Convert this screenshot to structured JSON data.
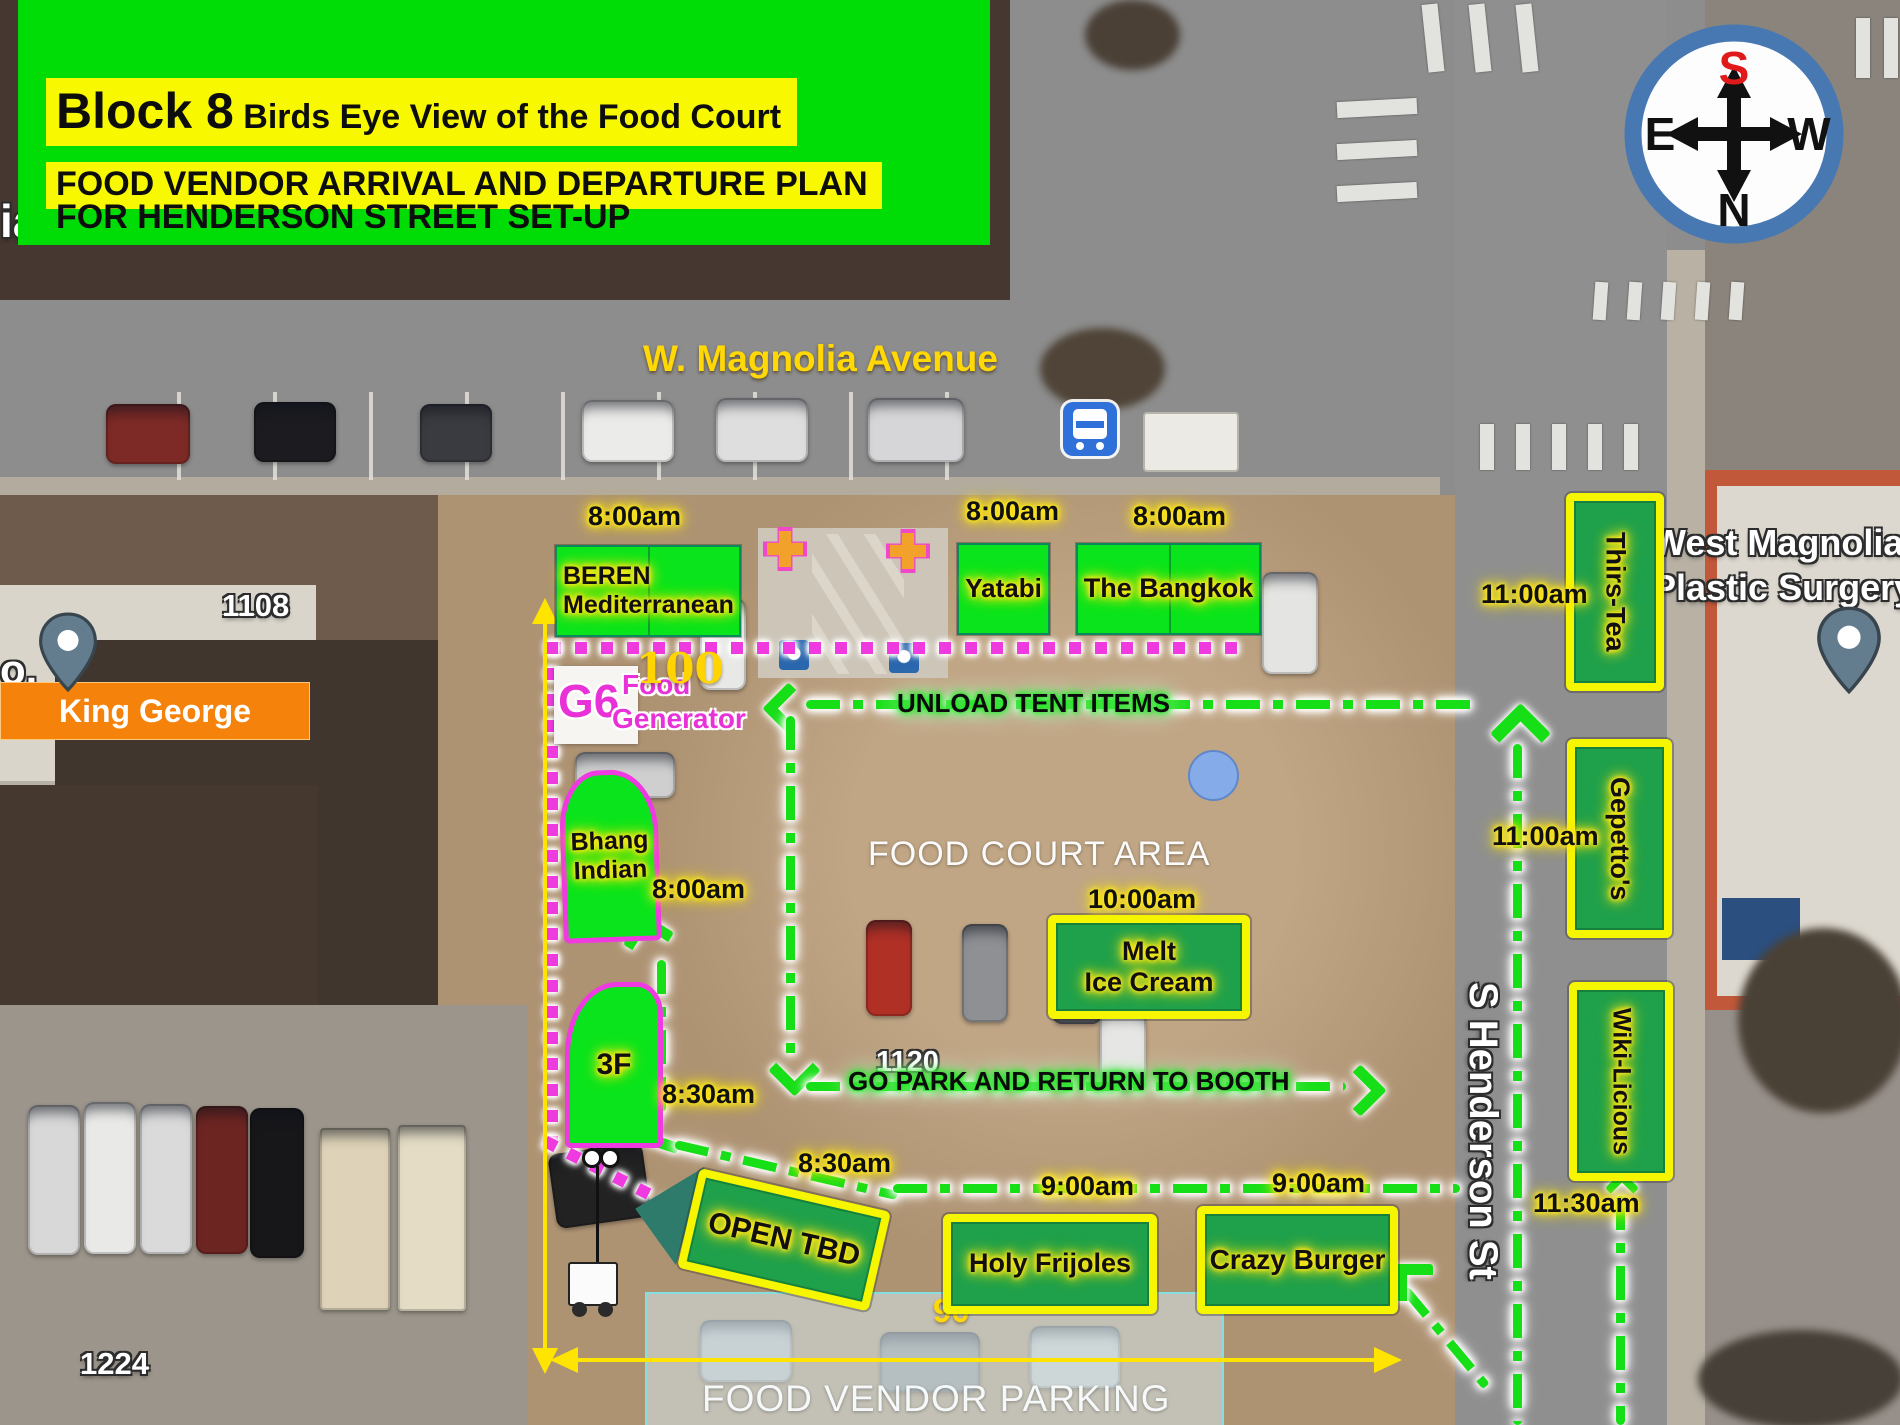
{
  "header": {
    "block": "Block 8",
    "subtitle": " Birds Eye View of the Food Court",
    "line2": "FOOD VENDOR ARRIVAL AND DEPARTURE PLAN",
    "line3": "FOR HENDERSON STREET SET-UP"
  },
  "compass": {
    "top": "S",
    "bottom": "N",
    "left": "E",
    "right": "W"
  },
  "streets": {
    "magnolia": "W. Magnolia Avenue",
    "henderson": "S Henderson St"
  },
  "areas": {
    "food_court": "FOOD COURT AREA",
    "vendor_parking": "FOOD VENDOR PARKING"
  },
  "routes": {
    "unload": "UNLOAD TENT ITEMS",
    "go_park": "GO PARK AND RETURN TO BOOTH"
  },
  "vendors": {
    "beren": {
      "line1": "BEREN",
      "line2": "Mediterranean",
      "time": "8:00am"
    },
    "yatabi": {
      "name": "Yatabi",
      "time": "8:00am"
    },
    "bangkok": {
      "name": "The Bangkok",
      "time": "8:00am"
    },
    "thirstea": {
      "name": "Thirs-Tea",
      "time": "11:00am"
    },
    "gepettos": {
      "name": "Gepetto's",
      "time": "11:00am"
    },
    "wikilicious": {
      "name": "Wiki-Licious",
      "time": "11:30am"
    },
    "melt": {
      "line1": "Melt",
      "line2": "Ice Cream",
      "time": "10:00am"
    },
    "holy": {
      "name": "Holy Frijoles",
      "time": "9:00am"
    },
    "crazy": {
      "name": "Crazy Burger",
      "time": "9:00am"
    },
    "bhang": {
      "line1": "Bhang",
      "line2": "Indian",
      "time": "8:00am"
    },
    "threef": {
      "name": "3F",
      "time": "8:30am"
    },
    "open": {
      "name": "OPEN TBD",
      "time": "8:30am"
    }
  },
  "labels": {
    "king_george": "King George",
    "west_magnolia_line1": "West Magnolia",
    "west_magnolia_line2": "Plastic Surgery",
    "g6": "G6",
    "generator_line1": "Food",
    "generator_line2": "Generator",
    "num_100": "100",
    "num_90": "90",
    "addr_1108": "1108",
    "addr_1120": "1120",
    "addr_1224": "1224",
    "edge_left_top": "ia",
    "edge_left_mid": "o."
  },
  "colors": {
    "header_green": "#00dc05",
    "highlight_yellow": "#f8f800",
    "booth_bright_green": "#0ae41c",
    "booth_dark_green": "#1fa04b",
    "booth_border_yellow": "#f6f600",
    "booth_border_magenta": "#ee3ae0",
    "route_green": "#17df17",
    "line_magenta": "#ee3adf",
    "measure_yellow": "#ffe400",
    "king_george_orange": "#f5820b"
  }
}
